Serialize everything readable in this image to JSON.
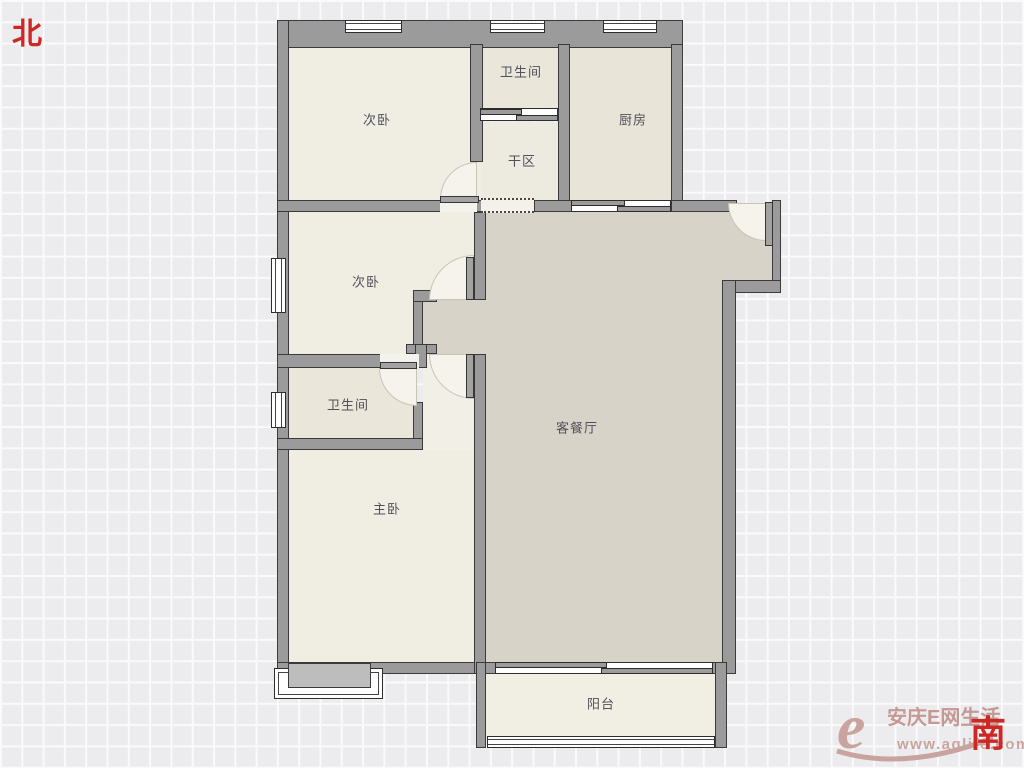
{
  "compass": {
    "north": "北",
    "south": "南"
  },
  "rooms": {
    "bedroom_north": {
      "label": "次卧"
    },
    "bathroom_north": {
      "label": "卫生间"
    },
    "kitchen": {
      "label": "厨房"
    },
    "dry_area": {
      "label": "干区"
    },
    "bedroom_west": {
      "label": "次卧"
    },
    "bathroom_west": {
      "label": "卫生间"
    },
    "master_bedroom": {
      "label": "主卧"
    },
    "living_dining": {
      "label": "客餐厅"
    },
    "balcony": {
      "label": "阳台"
    }
  },
  "watermark": {
    "logo_letter": "e",
    "site_name": "安庆E网生活",
    "site_url": "www.aqlife.com"
  },
  "colors": {
    "wall": "#9b9b9b",
    "wall_border": "#3a3a3a",
    "room_light": "#f0ede3",
    "living_fill": "#d8d3c9",
    "compass_red": "#cd2823",
    "watermark_pink": "#c79e98",
    "grid_bg": "#ececee"
  }
}
